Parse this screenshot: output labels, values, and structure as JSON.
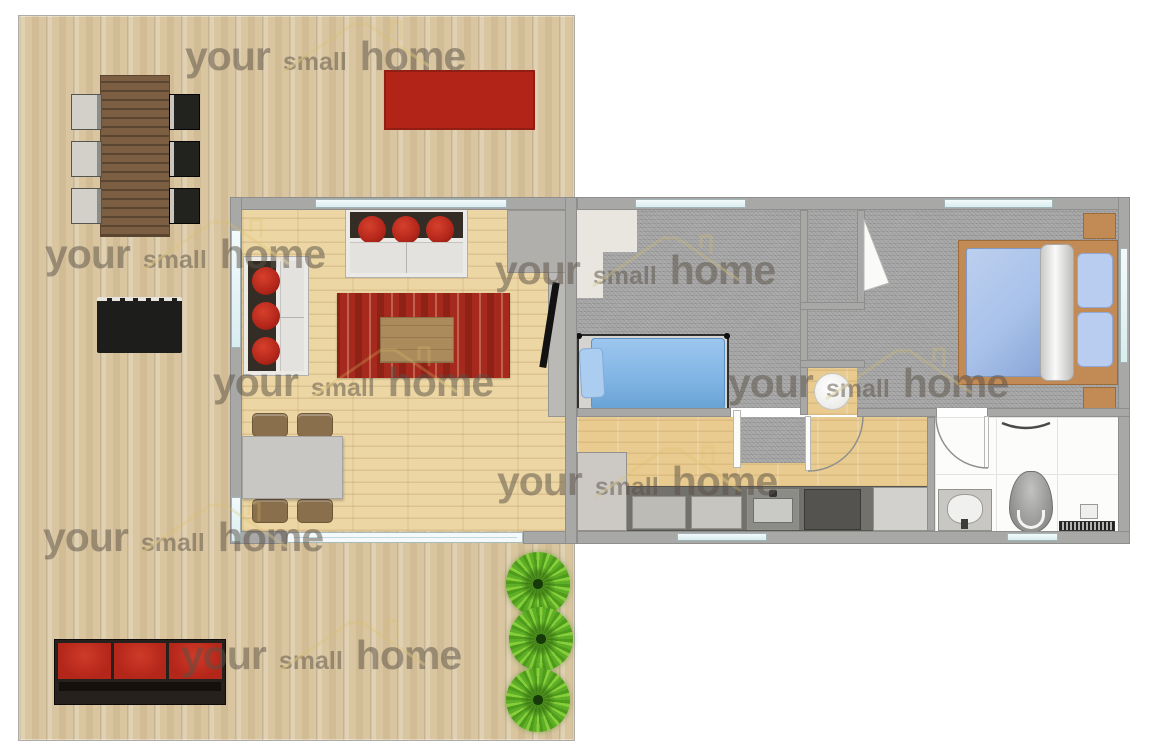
{
  "watermark": {
    "words": [
      "your",
      "small",
      "home"
    ],
    "color": "#5a5146",
    "opacity": 0.5,
    "roof_color": "#d9c06a",
    "instances": [
      {
        "x": 185,
        "y": 36
      },
      {
        "x": 45,
        "y": 234
      },
      {
        "x": 495,
        "y": 250
      },
      {
        "x": 213,
        "y": 362
      },
      {
        "x": 728,
        "y": 363
      },
      {
        "x": 497,
        "y": 461
      },
      {
        "x": 43,
        "y": 517
      },
      {
        "x": 181,
        "y": 635
      }
    ]
  },
  "palette": {
    "deck-floor": "#d9c6a0",
    "indoor-floor": "#ecd6a4",
    "corridor-floor": "#e9cb90",
    "carpet": "#a6a6a6",
    "wall": "#a8a8a6",
    "wall-edge": "#8e8e8c",
    "window": "#f3fafb",
    "outdoor-rug": "#b22418",
    "rug-red": "#a5291c",
    "rug-red-dark": "#8e2217",
    "cushion-red": "#b3261a",
    "single-bed": "#7fb4e4",
    "double-bed": "#a9c2ea",
    "bed-frame-wood": "#c28a55",
    "furniture-wood": "#8a6f4c",
    "table-top": "#c9c7c3",
    "plant": "#5fae27",
    "tile": "#fcfcfb",
    "counter": "#73716b"
  }
}
